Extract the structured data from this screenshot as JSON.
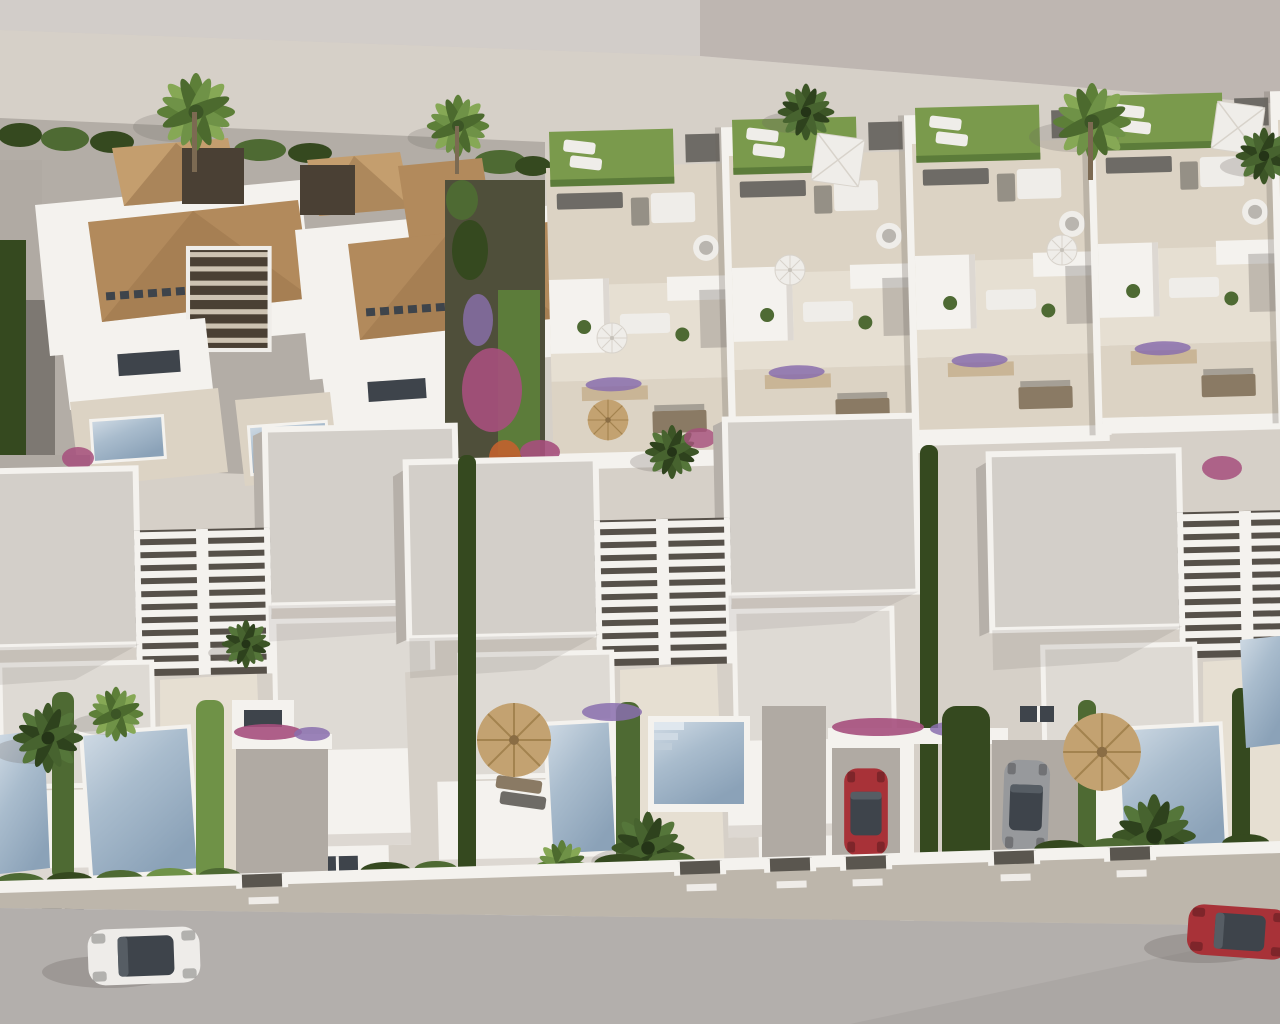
{
  "scene": {
    "description": "Aerial 3D architectural render of a coastal residential development: a back row with two Mediterranean villas with terracotta tiled roofs and a terraced townhouse row with roof gardens, a front row of modern white semi-detached villas with slatted pergolas, private pools, palm trees, hedges, parked cars and an access road along the bottom",
    "view": "aerial oblique",
    "inventory": {
      "mediterranean_villas": 2,
      "townhouse_units": 5,
      "modern_villa_pairs": 3,
      "swimming_pools": 6,
      "roof_terraces_with_grass": 4,
      "white_parasols": 4,
      "straw_parasols": 3,
      "cars": {
        "white_car_on_road": 1,
        "red_car_on_road": 1,
        "red_car_in_carport": 1,
        "silver_car_in_driveway": 1
      },
      "palm_trees": 14
    }
  },
  "colors": {
    "bg": "#cbc6c2",
    "bgTopDark": "#beb6b1",
    "bgTopLight": "#d2cdc9",
    "road": "#b3afac",
    "sidewalk": "#bdb6ab",
    "plot": "#d6d0c8",
    "wall": "#f4f2ee",
    "wallFace": "#ddd8d2",
    "wallShadow": "#b6b0a9",
    "roof": "#d3cfc9",
    "roofLight": "#dedad4",
    "terrace": "#dcd3c4",
    "terraceLight": "#e6dfd2",
    "gravel": "#b0aaa3",
    "gravelDark": "#7d7872",
    "grass": "#7a9a4c",
    "grassDark": "#5c7c3a",
    "hedge": "#4e6a33",
    "hedgeDark": "#35491f",
    "hedgeLight": "#6f9247",
    "palmLight": "#86a855",
    "palmMid": "#5d7f38",
    "palmDark": "#3c5526",
    "pool": "#a9bccd",
    "poolLight": "#cfdae4",
    "poolDark": "#8ba2b8",
    "tile": "#b28a5c",
    "tileDark": "#96714a",
    "tileLight": "#c49e6e",
    "stone": "#c9b596",
    "straw": "#c3a271",
    "strawDark": "#a3834f",
    "furn": "#b9b5af",
    "furnWhite": "#efede9",
    "furnDark": "#6e6b66",
    "furnBrown": "#8a7a64",
    "glass": "#3e444b",
    "slatGap": "#57514a",
    "flowerMagenta": "#a64f7d",
    "flowerPurple": "#8a6fae",
    "flowerOrange": "#c2622f",
    "carWhite": "#eeece9",
    "carRed": "#a83238",
    "carSilver": "#97999c",
    "shadow": "#6b655f"
  }
}
